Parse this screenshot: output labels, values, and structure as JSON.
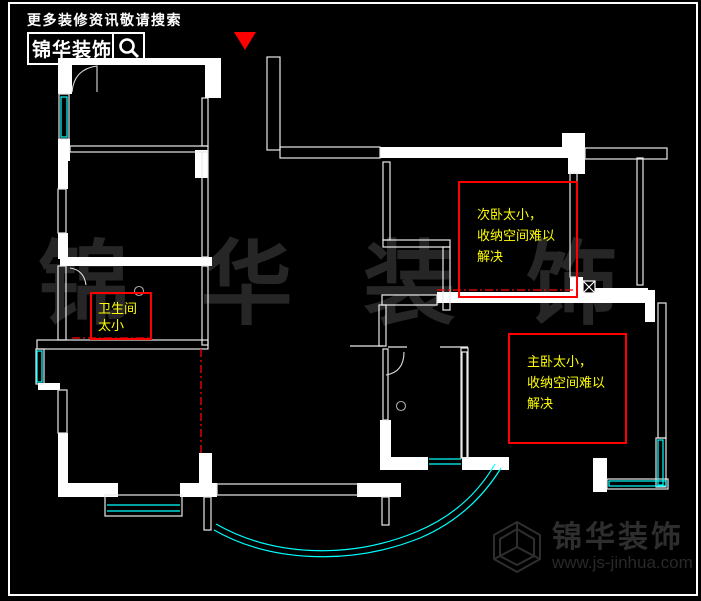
{
  "header": {
    "tagline": "更多装修资讯敬请搜索",
    "brand": "锦华装饰",
    "search_icon": "magnifier-icon"
  },
  "entrance_marker": {
    "shape": "red-triangle-down",
    "color": "#ff0000"
  },
  "annotations": {
    "bathroom": {
      "lines": [
        "卫生间",
        "太小"
      ]
    },
    "secondary_bedroom": {
      "lines": [
        "次卧太小，",
        "收纳空间难以",
        "解决"
      ]
    },
    "master_bedroom": {
      "lines": [
        "主卧太小，",
        "收纳空间难以",
        "解决"
      ]
    }
  },
  "watermark": {
    "chars": [
      "锦",
      "华",
      "装",
      "饰"
    ]
  },
  "footer": {
    "brand": "锦华装饰",
    "url": "www.js-jinhua.com",
    "logo_icon": "cube-wireframe-icon"
  },
  "colors": {
    "background": "#000000",
    "wall": "#ffffff",
    "window": "#00ffff",
    "highlight": "#ff0000",
    "note_text": "#ffff00",
    "watermark": "#262626"
  }
}
